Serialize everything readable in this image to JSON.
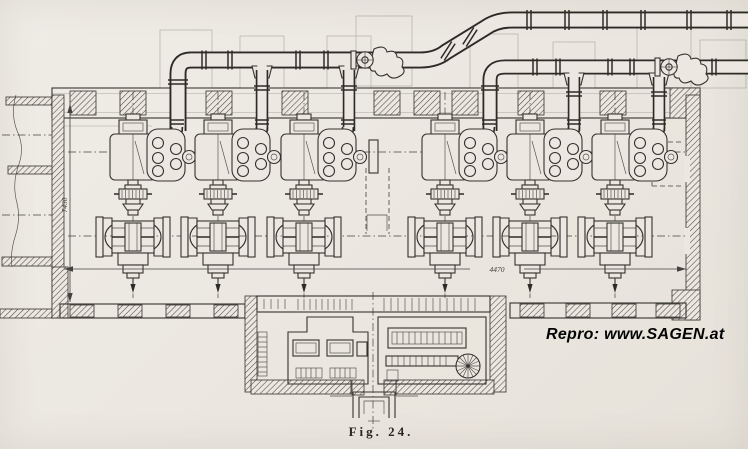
{
  "page": {
    "background": "#ece8e1",
    "ink": "#312e29"
  },
  "figure": {
    "caption": "Fig. 24."
  },
  "watermark": {
    "text": "Repro: www.SAGEN.at",
    "color": "#000000"
  },
  "dimensions": {
    "hall_length_label": "4470",
    "hall_width_label": "7430"
  },
  "drawing": {
    "pump_unit_count": 6
  }
}
